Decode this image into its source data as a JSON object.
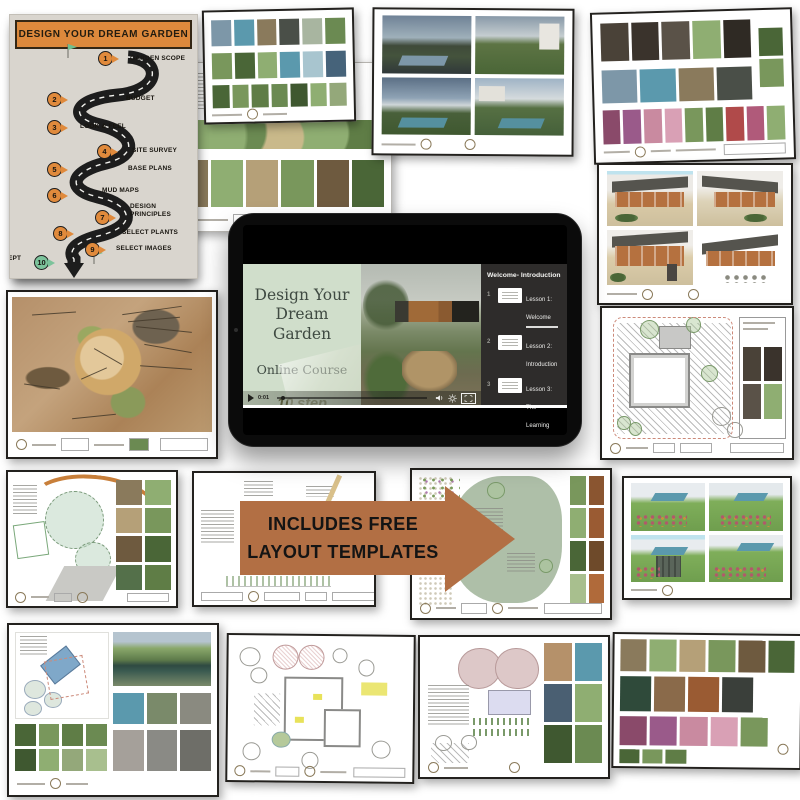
{
  "flowchart": {
    "title": "DESIGN YOUR DREAM GARDEN",
    "header_color": "#dd893c",
    "steps": [
      {
        "num": "1",
        "label": "GARDEN SCOPE",
        "px": 88,
        "py": 6,
        "lx": 120,
        "ly": 10,
        "color": "#e08a3c"
      },
      {
        "num": "2",
        "label": "BUDGET",
        "px": 37,
        "py": 47,
        "lx": 116,
        "ly": 50,
        "color": "#e08a3c"
      },
      {
        "num": "3",
        "label": "LOOK & FEEL",
        "px": 37,
        "py": 75,
        "lx": 70,
        "ly": 78,
        "color": "#e08a3c"
      },
      {
        "num": "4",
        "label": "SITE SURVEY",
        "px": 87,
        "py": 99,
        "lx": 122,
        "ly": 102,
        "color": "#e08a3c"
      },
      {
        "num": "5",
        "label": "BASE PLANS",
        "px": 37,
        "py": 117,
        "lx": 118,
        "ly": 120,
        "color": "#e08a3c"
      },
      {
        "num": "6",
        "label": "MUD MAPS",
        "px": 37,
        "py": 143,
        "lx": 92,
        "ly": 142,
        "color": "#e08a3c"
      },
      {
        "num": "7",
        "label": "DESIGN PRINCIPLES",
        "px": 85,
        "py": 165,
        "lx": 120,
        "ly": 158,
        "w": 46,
        "color": "#e08a3c"
      },
      {
        "num": "8",
        "label": "SELECT PLANTS",
        "px": 43,
        "py": 181,
        "lx": 112,
        "ly": 184,
        "color": "#e08a3c"
      },
      {
        "num": "9",
        "label": "SELECT IMAGES",
        "px": 75,
        "py": 197,
        "lx": 106,
        "ly": 200,
        "color": "#e08a3c"
      },
      {
        "num": "10",
        "label": "CONCEPT PLAN",
        "px": 24,
        "py": 210,
        "lx": -22,
        "ly": 210,
        "w": 44,
        "color": "#7cc39b"
      }
    ]
  },
  "tablet": {
    "slide": {
      "title": "Design Your Dream Garden",
      "subtitle": "Online Course",
      "note_line1": "10 step",
      "note_line2": "framework"
    },
    "sidebar": {
      "header": "Welcome- Introduction",
      "lessons": [
        {
          "num": "1",
          "label": "Lesson 1: Welcome",
          "progress": true
        },
        {
          "num": "2",
          "label": "Lesson 2: Introduction"
        },
        {
          "num": "3",
          "label": "Lesson 3: The Learning Notion"
        },
        {
          "num": "4",
          "label": "Lesson 4: Software & M"
        }
      ],
      "next_button": "Next Module"
    },
    "player": {
      "time": "0:01"
    }
  },
  "banner": {
    "line1": "INCLUDES FREE",
    "line2": "LAYOUT TEMPLATES",
    "color": "#b26f44"
  }
}
